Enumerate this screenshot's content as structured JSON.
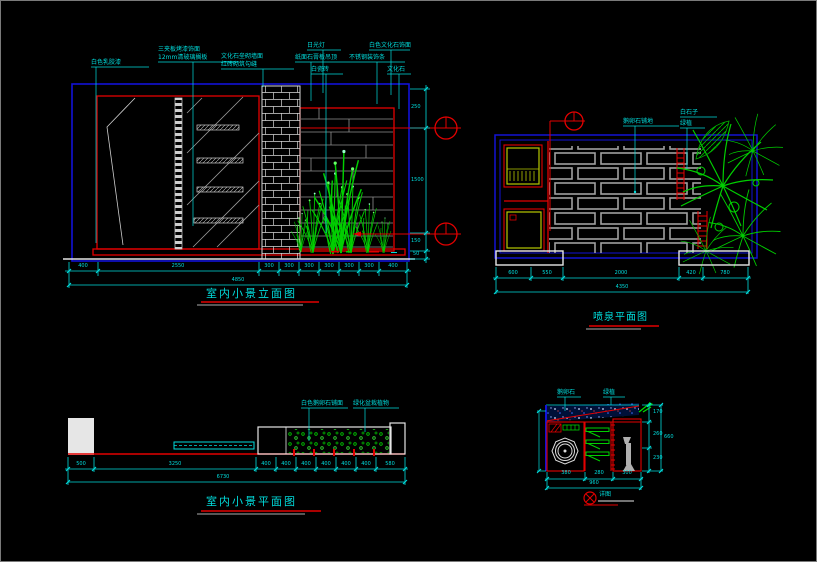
{
  "colors": {
    "cyan": "#00dcdc",
    "red": "#e30000",
    "blue": "#1212d6",
    "green": "#00cf00",
    "white": "#e6e6e6",
    "brick_gray": "#a0a0a0",
    "planter_yellow": "#b6c800"
  },
  "elevation": {
    "title": "室内小景立面图",
    "labels": {
      "paint": "白色乳胶漆",
      "veneer": "三夹板烤漆饰面",
      "glass": "12mm清玻璃搁板",
      "stone_wall": "文化石垒砌墙面",
      "brick": "红砖砌筑勾缝",
      "lamp": "日光灯",
      "gypsum": "纸面石膏板吊顶",
      "tile": "白瓷砖",
      "stone_face": "白色文化石饰面",
      "steel": "不锈钢装饰条",
      "culture_stone": "文化石"
    },
    "dims_bottom": [
      "400",
      "2550",
      "300",
      "300",
      "300",
      "300",
      "300",
      "300",
      "400"
    ],
    "dim_total": "4850",
    "dims_right": [
      "250",
      "1500",
      "150",
      "50"
    ]
  },
  "plan": {
    "title": "喷泉平面图",
    "labels": {
      "paving": "鹅卵石铺地",
      "white_stone": "白石子",
      "plant": "绿植"
    },
    "dims_bottom": [
      "600",
      "550",
      "2000",
      "420",
      "780"
    ],
    "dim_total": "4350"
  },
  "floor_plan": {
    "title": "室内小景平面图",
    "labels": {
      "pebble": "白色鹅卵石铺面",
      "plants": "绿化盆栽植物"
    },
    "dims_bottom": [
      "500",
      "3250",
      "400",
      "400",
      "400",
      "400",
      "400",
      "400",
      "580"
    ],
    "dim_total": "6730"
  },
  "detail": {
    "labels": {
      "pebble": "鹅卵石",
      "plant": "绿植",
      "caption": "详图"
    },
    "dims_right": [
      "170",
      "260",
      "230"
    ],
    "dim_right_total": "660",
    "dims_bottom": [
      "380",
      "280",
      "300"
    ],
    "dim_total": "960"
  }
}
